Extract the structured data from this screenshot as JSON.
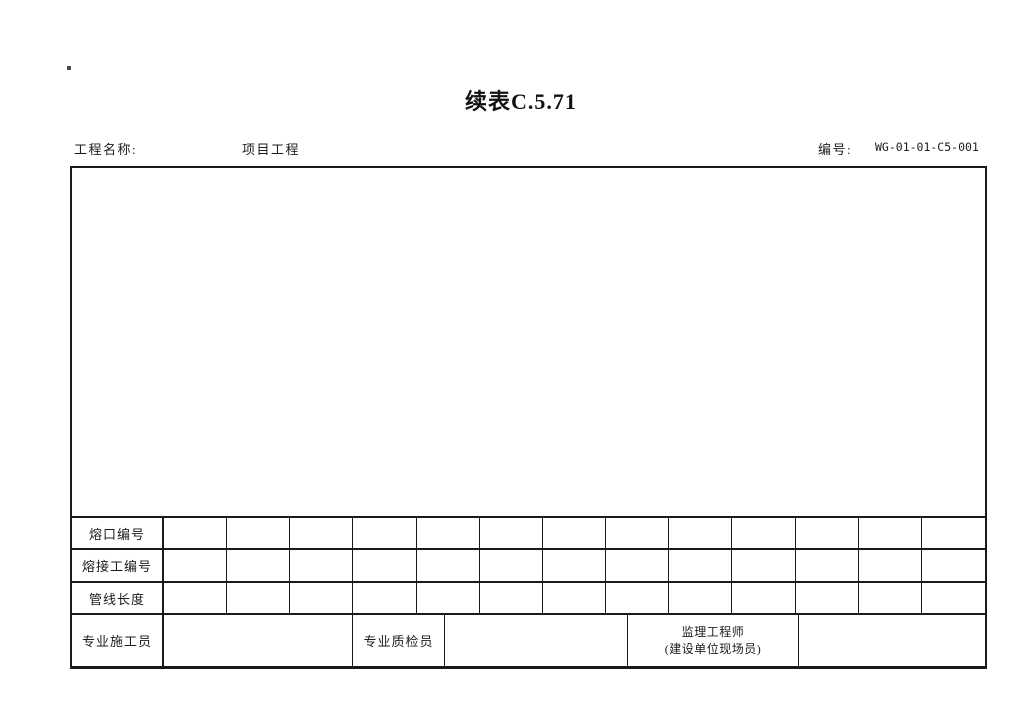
{
  "page": {
    "title": "续表C.5.71",
    "corner_mark": "."
  },
  "header": {
    "project_label": "工程名称:",
    "project_value": "项目工程",
    "number_label": "编号:",
    "number_value": "WG-01-01-C5-001"
  },
  "table": {
    "data_columns": 13,
    "rows": [
      {
        "label": "熔口编号"
      },
      {
        "label": "熔接工编号"
      },
      {
        "label": "管线长度"
      }
    ],
    "signature_row": {
      "constructor_label": "专业施工员",
      "inspector_label": "专业质检员",
      "supervisor_label_line1": "监理工程师",
      "supervisor_label_line2": "(建设单位现场员)"
    }
  },
  "colors": {
    "line": "#1a1a1a",
    "text": "#1c1c1c",
    "background": "#ffffff"
  }
}
